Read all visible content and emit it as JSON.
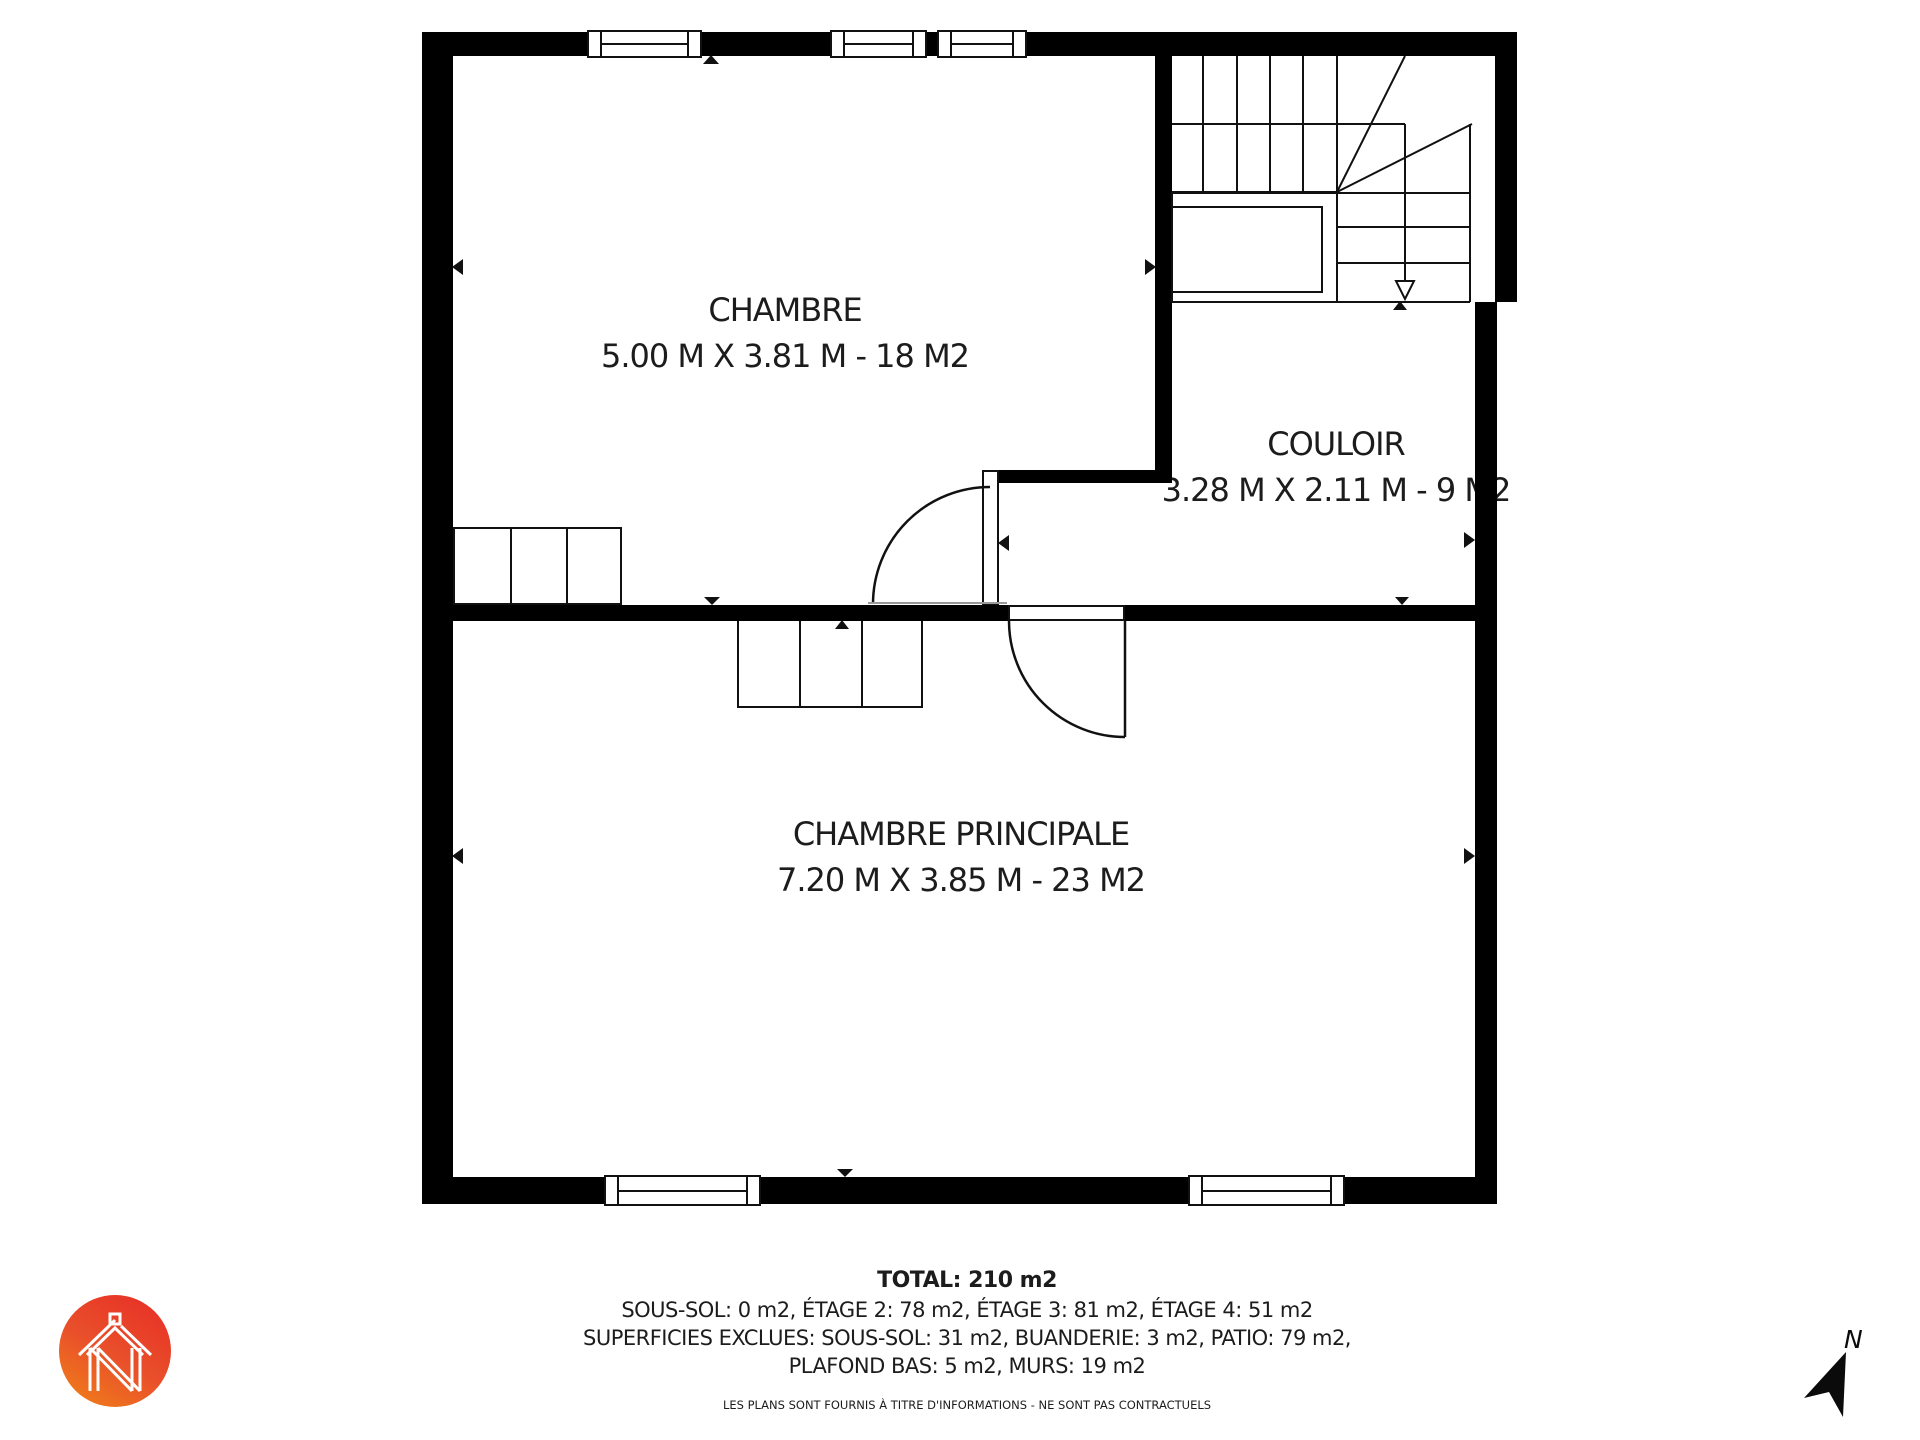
{
  "rooms": [
    {
      "name": "CHAMBRE",
      "dims": "5.00 M X 3.81 M - 18 M2"
    },
    {
      "name": "COULOIR",
      "dims": "3.28 M X 2.11 M - 9 M2"
    },
    {
      "name": "CHAMBRE PRINCIPALE",
      "dims": "7.20 M X 3.85 M - 23 M2"
    }
  ],
  "footer": {
    "total": "TOTAL: 210 m2",
    "line_floors": "SOUS-SOL: 0 m2, ÉTAGE 2: 78 m2, ÉTAGE 3: 81 m2, ÉTAGE 4: 51 m2",
    "line_excluded_1": "SUPERFICIES EXCLUES: SOUS-SOL: 31 m2, BUANDERIE: 3 m2, PATIO: 79 m2,",
    "line_excluded_2": "PLAFOND BAS: 5 m2, MURS: 19 m2",
    "disclaimer": "LES PLANS SONT FOURNIS À TITRE D'INFORMATIONS - NE SONT PAS CONTRACTUELS"
  },
  "compass": {
    "north_label": "N"
  },
  "colors": {
    "wall": "#000000",
    "line": "#111111",
    "text": "#1c1c1c",
    "logo_red": "#e73127",
    "logo_orange": "#f07c1a"
  }
}
